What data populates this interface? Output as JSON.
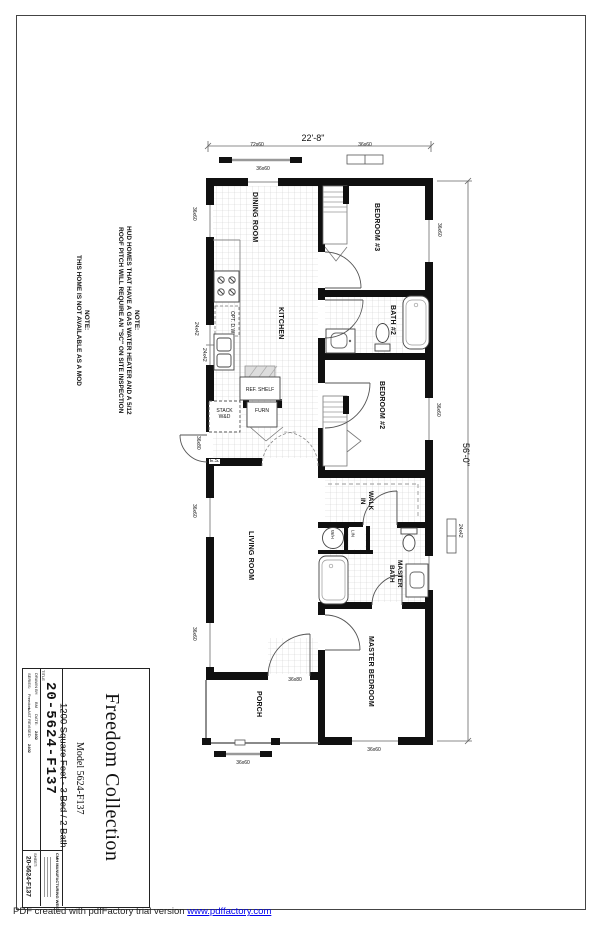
{
  "notes": {
    "n1_title": "NOTE:",
    "n1_line1": "HUD HOMES THAT HAVE A GAS WATER HEATER AND A 5/12",
    "n1_line2": "ROOF PITCH WILL REQUIRE AN \"SC\" ON SITE INSPECTION",
    "n2_title": "NOTE:",
    "n2_line1": "THIS HOME IS NOT AVAILABLE AS A MOD"
  },
  "dimensions": {
    "width": "22'-8\"",
    "length": "56'-0\""
  },
  "rooms": {
    "dining": "DINING ROOM",
    "kitchen": "KITCHEN",
    "bedroom3": "BEDROOM #3",
    "bath2": "BATH #2",
    "bedroom2": "BEDROOM #2",
    "walkin_1": "WALK",
    "walkin_2": "IN",
    "master_bath_1": "MASTER",
    "master_bath_2": "BATH",
    "living": "LIVING ROOM",
    "master_bedroom": "MASTER BEDROOM",
    "porch": "PORCH"
  },
  "fixtures": {
    "ref_shelf": "REF. SHELF",
    "stack_1": "STACK",
    "stack_2": "W&D",
    "furnace": "FURN",
    "entry_switch": "E.S.",
    "opt_dishwasher": "OPT. D.W.",
    "water_heater": "W/H",
    "linen": "LIN"
  },
  "openings": {
    "top_shipped_72x60": "72x60",
    "top_shipped_36x60": "36x60",
    "top_wall_window": "36x60",
    "dining_window": "36x60",
    "kitchen_window_a": "24x42",
    "kitchen_window_b": "24x42",
    "side_door": "36x80",
    "living_window_a": "36x60",
    "living_window_b": "36x60",
    "bedroom3_window": "36x60",
    "bedroom2_window": "36x60",
    "master_bath_window": "24x42",
    "front_door": "36x80",
    "master_bedroom_window": "36x60",
    "porch_shipped_window": "36x60"
  },
  "title_block": {
    "collection": "Freedom Collection",
    "model": "Model 5624-F137",
    "specs": "1200 Square Feet - 3 Bed / 2 Bath",
    "plan_number": "20-5624-F137",
    "title_label": "TITLE",
    "drawn_by_label": "DRAWN BY:",
    "drawn_by": "BM",
    "date_label": "DATE:",
    "date": "2402",
    "series_label": "SERIES:",
    "series": "Freedom",
    "last_revised_label": "LAST REVISED:",
    "last_revised": "2402",
    "sheet_label": "SHEET:",
    "sheet_number": "20-5624-F137",
    "company": "CMH MANUFACTURING WEST"
  },
  "footer": {
    "text": "PDF created with pdfFactory trial version ",
    "link": "www.pdffactory.com"
  }
}
